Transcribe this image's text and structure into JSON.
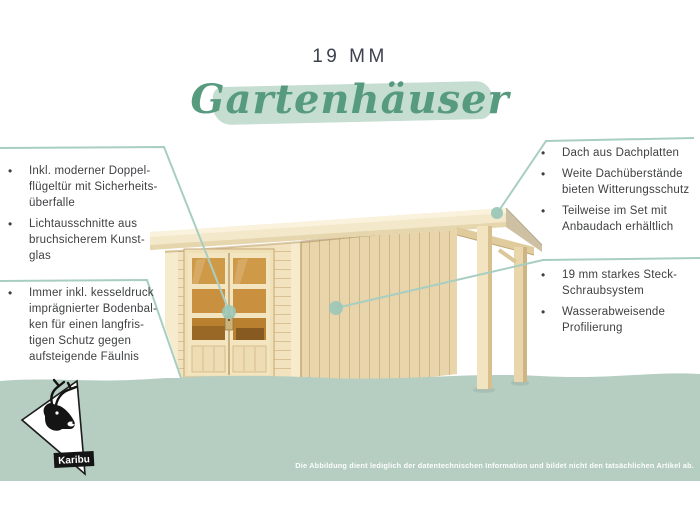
{
  "title": {
    "size_label": "19 MM",
    "script_label": "Gartenhäuser"
  },
  "callouts": {
    "bullet_char": "•",
    "left_top": {
      "items": [
        {
          "lines": [
            "Inkl. moderner Doppel-",
            "flügeltür mit Sicherheits-",
            "überfalle"
          ]
        },
        {
          "lines": [
            "Lichtausschnitte aus",
            "bruchsicherem Kunst-",
            "glas"
          ]
        }
      ]
    },
    "left_bottom": {
      "items": [
        {
          "lines": [
            "Immer inkl. kesseldruck",
            "imprägnierter Bodenbal-",
            "ken für einen langfris-",
            "tigen Schutz gegen",
            "aufsteigende Fäulnis"
          ]
        }
      ]
    },
    "right_top": {
      "items": [
        {
          "lines": [
            "Dach aus Dachplatten"
          ]
        },
        {
          "lines": [
            "Weite Dachüberstände",
            "bieten Witterungsschutz"
          ]
        },
        {
          "lines": [
            "Teilweise im Set mit",
            "Anbaudach erhältlich"
          ]
        }
      ]
    },
    "right_bottom": {
      "items": [
        {
          "lines": [
            "19 mm starkes Steck-",
            "Schraubsystem"
          ]
        },
        {
          "lines": [
            "Wasserabweisende",
            "Profilierung"
          ]
        }
      ]
    }
  },
  "footer": {
    "disclaimer": "Die Abbildung dient lediglich der datentechnischen Information und bildet nicht den tatsächlichen Artikel ab."
  },
  "logo": {
    "brand": "Karibu"
  },
  "colors": {
    "accent_green": "#579b7f",
    "brush_green": "#c6ddd1",
    "band_green": "#b6cec1",
    "callout_line_teal": "#a8cec2",
    "callout_dot_teal": "#9bc7b8",
    "text_dark": "#3e3f41",
    "wood_front": "#f2e2bd",
    "wood_side": "#e9d5ab",
    "door_glass_amber": "#cf9a47"
  }
}
